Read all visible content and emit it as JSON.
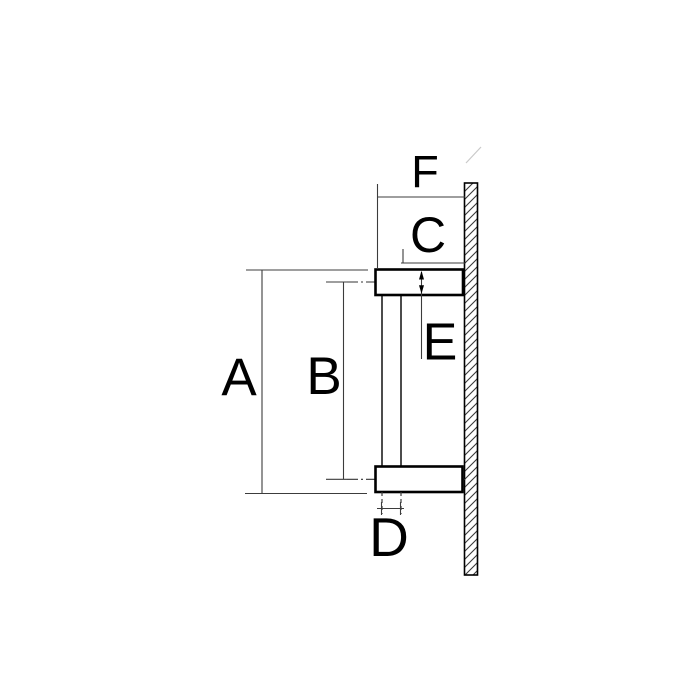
{
  "drawing": {
    "dimension_labels": {
      "a": "A",
      "b": "B",
      "c": "C",
      "d": "D",
      "e": "E",
      "f": "F"
    }
  },
  "colors": {
    "background": "#ffffff",
    "outline": "#000000",
    "dimension_line": "#3c3c3c",
    "centerline": "#333333",
    "text": "#000000",
    "faint_artifact": "#c9c9c9"
  }
}
